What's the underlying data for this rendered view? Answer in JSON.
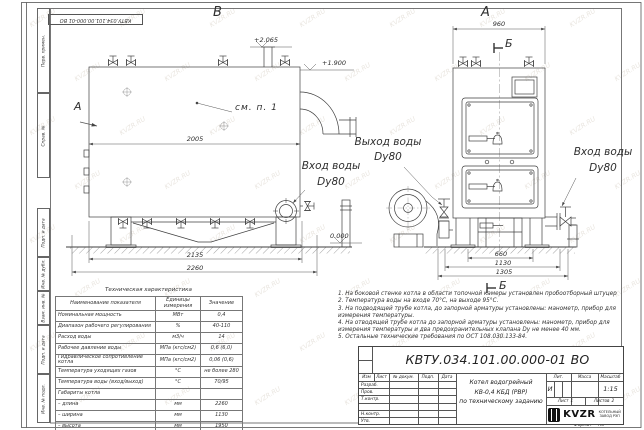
{
  "sheet": {
    "stamp_designation": "КВТУ.034.101.00.000-01 ВО",
    "watermark": "KVZR.RU",
    "format_label": "Формат",
    "format_value": "А3"
  },
  "margin_stamps": [
    "Перв. примен.",
    "Справ. №",
    "Подп. и дата",
    "Инв. № дубл.",
    "Взам. инв. №",
    "Подп. и дата",
    "Инв. № подл."
  ],
  "views": {
    "left": {
      "view_label": "В",
      "arrow_view_label": "А",
      "callout_see_note": "см. п. 1",
      "dim_body_length": "2005",
      "dim_frame_length": "2135",
      "dim_overall_length": "2260",
      "elev_top": "+2.065",
      "elev_mid": "+1.900",
      "elev_zero": "0.000",
      "inlet_line1": "Вход воды",
      "inlet_line2": "Dy80"
    },
    "right": {
      "view_label": "А",
      "section_label": "Б",
      "section_view_title": "Б",
      "dim_overall_width": "960",
      "dim_base_width": "660",
      "dim_width_1130": "1130",
      "dim_width_1305": "1305",
      "outlet_line1": "Выход воды",
      "outlet_line2": "Dy80",
      "inlet_line1": "Вход воды",
      "inlet_line2": "Dy80"
    }
  },
  "char_table": {
    "title": "Техническая характеристика",
    "col_name": "Наименование показателя",
    "col_units": "Единицы измерения",
    "col_value": "Значение",
    "rows": [
      {
        "name": "Номинальная мощность",
        "units": "МВт",
        "value": "0,4"
      },
      {
        "name": "Диапазон рабочего регулирования",
        "units": "%",
        "value": "40-110"
      },
      {
        "name": "Расход воды",
        "units": "м3/ч",
        "value": "14"
      },
      {
        "name": "Рабочее давление воды",
        "units": "МПа (кгс/см2)",
        "value": "0,6 (6,0)"
      },
      {
        "name": "Гидравлическое сопротивление котла",
        "units": "МПа (кгс/см2)",
        "value": "0,06 (0,6)"
      },
      {
        "name": "Температура уходящих газов",
        "units": "°С",
        "value": "не более 280"
      },
      {
        "name": "Температура воды (вход/выход)",
        "units": "°С",
        "value": "70/95"
      },
      {
        "name": "Габариты котла",
        "units": "",
        "value": ""
      },
      {
        "name": "– длина",
        "units": "мм",
        "value": "2260"
      },
      {
        "name": "– ширина",
        "units": "мм",
        "value": "1130"
      },
      {
        "name": "– высота",
        "units": "мм",
        "value": "1950"
      }
    ]
  },
  "notes": [
    "1. На боковой стенке котла в области топочной камеры установлен пробоотборный штуцер",
    "2. Температура воды на входе 70°С, на выходе 95°С.",
    "3. На подводящей трубе котла, до запорной арматуры установлены: манометр, прибор для измерения температуры.",
    "4. На отводящей трубе котла до запорной арматуры установлены: манометр, прибор для измерения температуры и два предохранительных клапана Dу не менее 40 мм.",
    "5. Остальные технические требования по ОСТ 108.030.133-84."
  ],
  "title_block": {
    "designation": "КВТУ.034.101.00.000-01 ВО",
    "header_cols": [
      "Изм",
      "Лист",
      "№ докум.",
      "Подп.",
      "Дата"
    ],
    "rows": [
      "Разраб.",
      "Пров.",
      "Т.контр.",
      "",
      "Н.контр.",
      "Утв."
    ],
    "description_line1": "Котел водогрейный",
    "description_line2": "КВ-0,4 КБД (РВР)",
    "description_line3": "по техническому заданию",
    "lit_label": "Лит.",
    "lit_value": "И",
    "mass_label": "Масса",
    "scale_label": "Масштаб",
    "scale_value": "1:15",
    "sheet_label": "Лист",
    "sheet_value": "1",
    "sheets_label": "Листов",
    "sheets_value": "2",
    "logo_text": "KVZR",
    "logo_sub1": "КОТЕЛЬНЫЙ",
    "logo_sub2": "ЗАВОД РЭП"
  }
}
